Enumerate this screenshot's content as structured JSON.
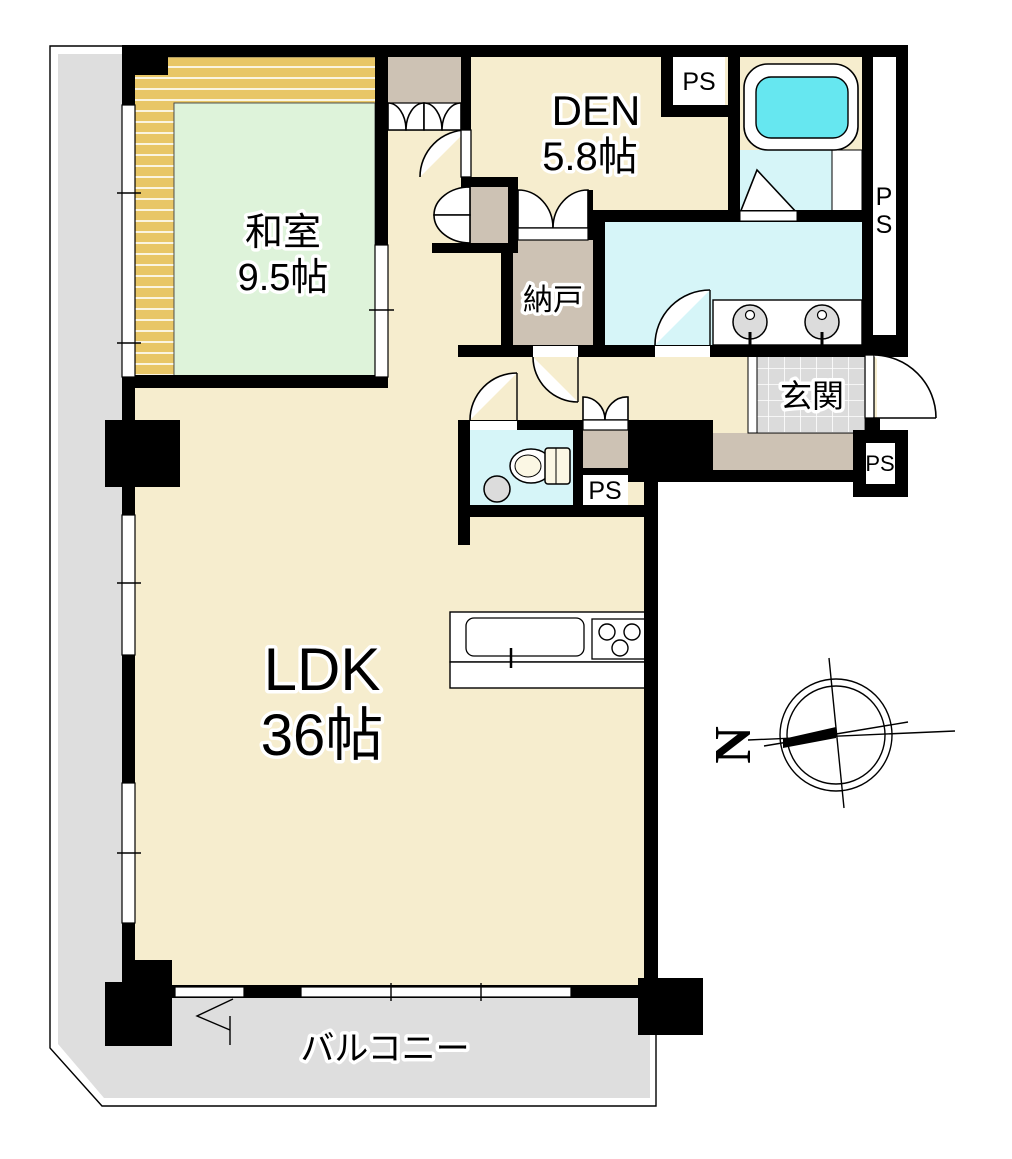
{
  "plan": {
    "rooms": {
      "washitsu": {
        "name": "和室",
        "size": "9.5帖"
      },
      "den": {
        "name": "DEN",
        "size": "5.8帖"
      },
      "ldk": {
        "name": "LDK",
        "size": "36帖"
      },
      "nando": {
        "name": "納戸"
      },
      "genkan": {
        "name": "玄関"
      },
      "balcony": {
        "name": "バルコニー"
      }
    },
    "shafts": {
      "ps": "PS",
      "ps_vertical_p": "P",
      "ps_vertical_s": "S"
    },
    "compass": {
      "north": "N"
    },
    "colors": {
      "wall": "#000000",
      "floor_cream": "#F6EDCE",
      "tatami_green": "#DEF3DA",
      "wood_trim": "#E8C666",
      "wet_area_cyan": "#D6F5F8",
      "tub_water": "#66E7F0",
      "closet_taupe": "#CDC2B4",
      "balcony_gray": "#DEDEDE",
      "entry_tile_gray": "#DBDBDB"
    }
  }
}
